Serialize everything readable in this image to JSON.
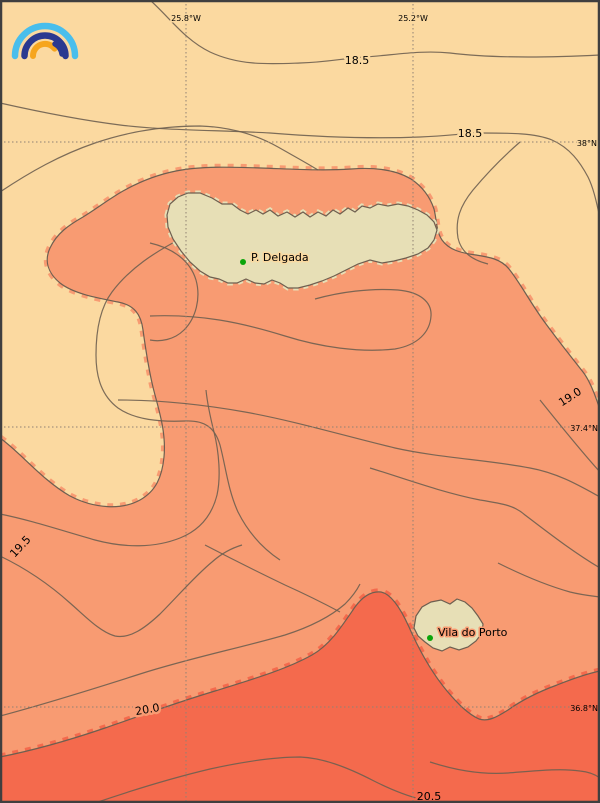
{
  "map": {
    "colors": {
      "band_18_19": "#fbd9a0",
      "band_19_20": "#f89b72",
      "band_20_21": "#f46a4d",
      "land": "#e7dfb6",
      "contour_line": "#6e5f50",
      "grid_line": "#8f8173",
      "frame": "#3f3f3f",
      "city_marker": "#0aa50a",
      "label_text": "#000000"
    },
    "top_axis_labels": [
      {
        "text": "25.8°W"
      },
      {
        "text": "25.2°W"
      }
    ],
    "right_axis_labels": [
      {
        "text": "38°N"
      },
      {
        "text": "37.4°N"
      },
      {
        "text": "36.8°N"
      }
    ],
    "contour_labels": [
      {
        "text": "18.5"
      },
      {
        "text": "18.5"
      },
      {
        "text": "19.0"
      },
      {
        "text": "19.5"
      },
      {
        "text": "20.0"
      },
      {
        "text": "20.5"
      }
    ],
    "cities": [
      {
        "name": "P. Delgada"
      },
      {
        "name": "Vila do Porto"
      }
    ],
    "logo": {
      "colors": {
        "outer_arc": "#49beec",
        "middle_arc": "#2b3990",
        "inner_arc": "#f6a51d"
      }
    }
  }
}
